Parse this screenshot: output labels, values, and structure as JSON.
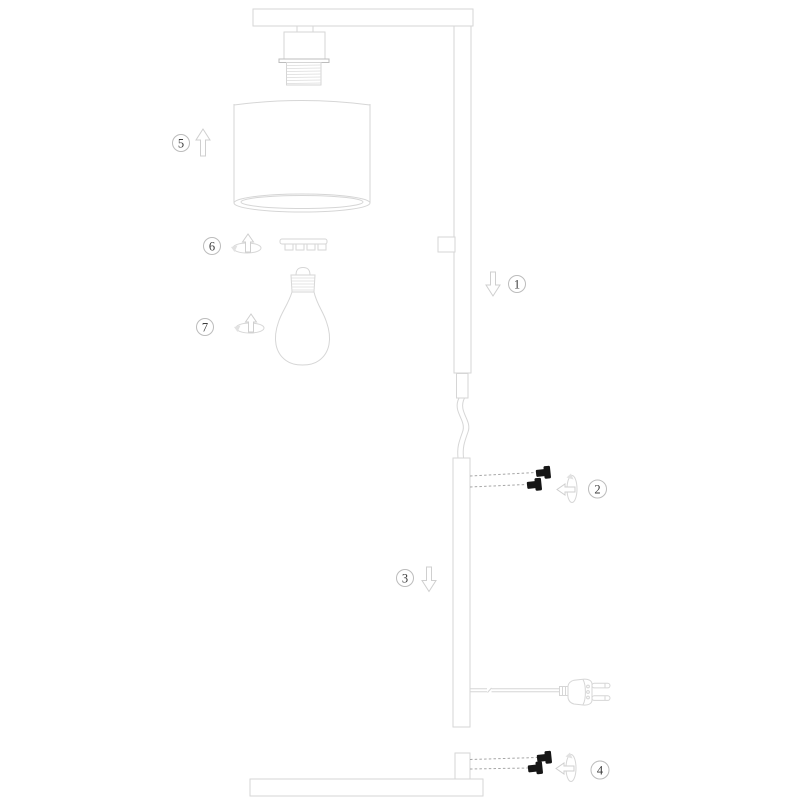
{
  "diagram": {
    "background": "#ffffff",
    "colors": {
      "part_outline": "#d6d6d6",
      "dark_outline": "#bdbdbd",
      "screw_fill": "#161616",
      "dashed_guide": "#a6a6a6",
      "callout_border": "#bcbcbc",
      "callout_text": "#3c3c3c"
    },
    "callouts": [
      {
        "number": "1",
        "icon": "arrow-down-icon"
      },
      {
        "number": "2",
        "icon": "twist-left-icon"
      },
      {
        "number": "3",
        "icon": "arrow-down-icon"
      },
      {
        "number": "4",
        "icon": "twist-left-icon"
      },
      {
        "number": "5",
        "icon": "arrow-up-icon"
      },
      {
        "number": "6",
        "icon": "twist-up-icon"
      },
      {
        "number": "7",
        "icon": "twist-up-icon"
      }
    ]
  }
}
